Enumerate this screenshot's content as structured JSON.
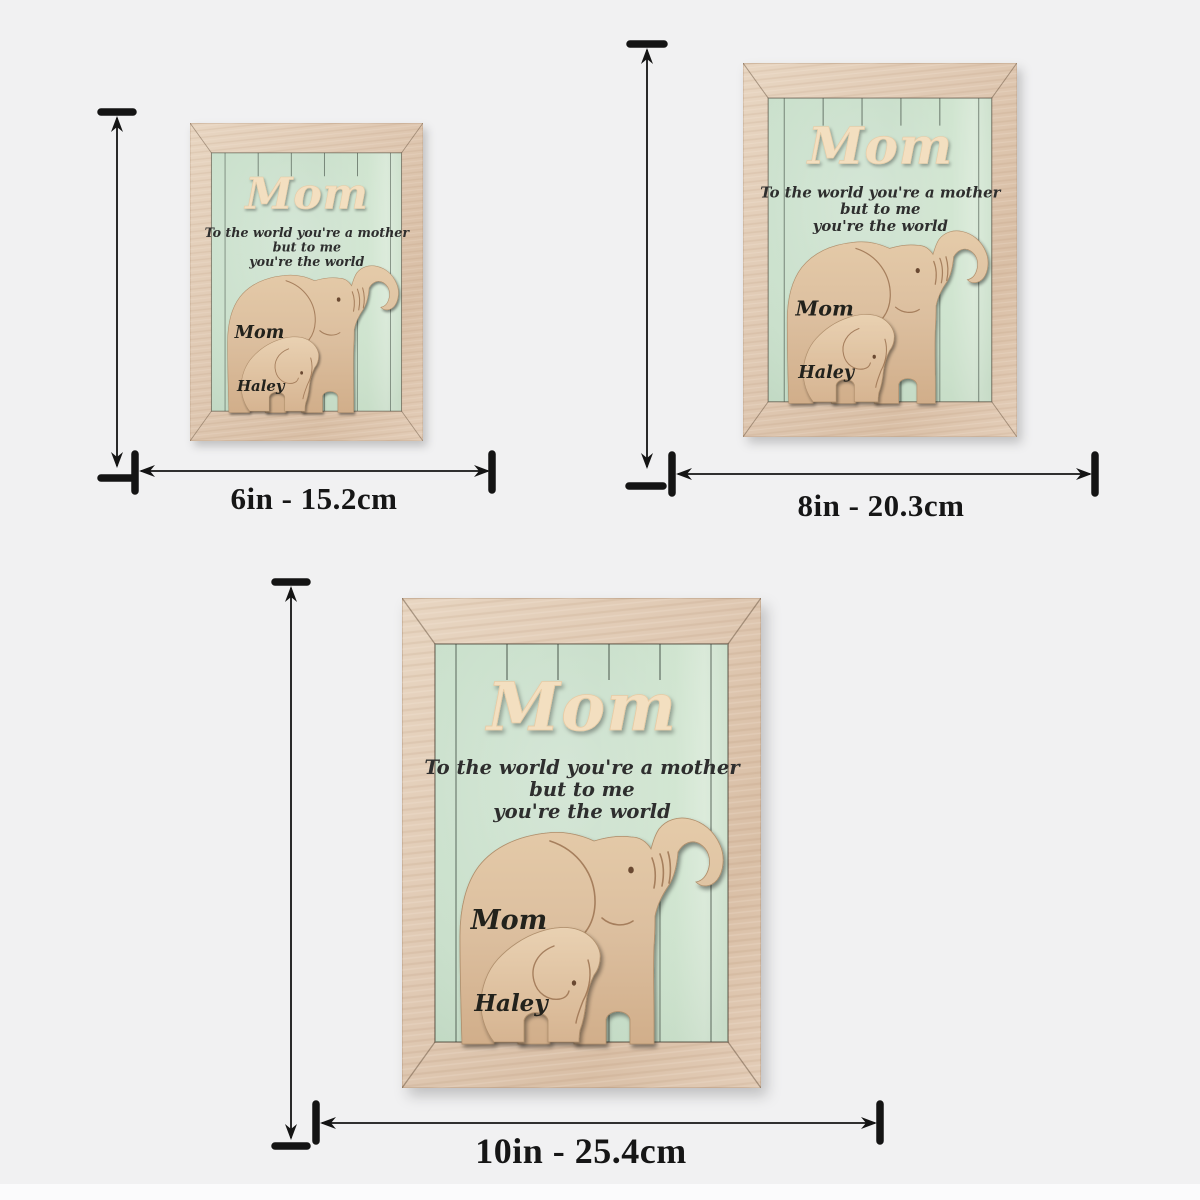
{
  "product": {
    "header": "Mom",
    "quote_lines": [
      "To the world you're a mother",
      "but to me",
      "you're the world"
    ],
    "mother_name": "Mom",
    "child_name": "Haley"
  },
  "sizes": {
    "small": {
      "label": "6in - 15.2cm"
    },
    "medium": {
      "label": "8in - 20.3cm"
    },
    "large": {
      "label": "10in - 25.4cm"
    }
  },
  "colors": {
    "canvas_background": "#f1f1f2",
    "frame_wood": "#dfc8b2",
    "panel_green": "#c6ddc8",
    "panel_green_light": "#daead9",
    "elephant_wood": "#dcbf9f",
    "engraving_brown": "#9c7351",
    "header_cream": "#f3dfc0",
    "script_text": "#2d2d2d",
    "arrow_black": "#141414"
  }
}
